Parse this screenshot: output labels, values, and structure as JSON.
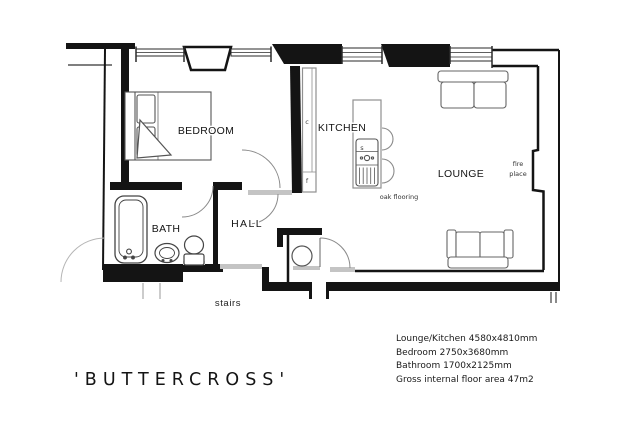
{
  "title": "'BUTTERCROSS'",
  "plan": {
    "rooms": [
      {
        "id": "bedroom",
        "label": "BEDROOM"
      },
      {
        "id": "kitchen",
        "label": "KITCHEN"
      },
      {
        "id": "lounge",
        "label": "LOUNGE"
      },
      {
        "id": "bath",
        "label": "BATH"
      },
      {
        "id": "hall",
        "label": "HALL"
      }
    ],
    "annotations": {
      "fireplace_line1": "fire",
      "fireplace_line2": "place",
      "oak_flooring": "oak flooring",
      "stairs": "stairs"
    },
    "fixture_labels": {
      "counter_c": "c",
      "counter_f": "f",
      "sink_s": "s"
    }
  },
  "notes": {
    "lines": [
      "Lounge/Kitchen 4580x4810mm",
      "Bedroom 2750x3680mm",
      "Bathroom 1700x2125mm",
      "Gross internal floor area 47m2"
    ]
  },
  "colors": {
    "ink": "#141414",
    "furniture_line": "#555555",
    "sill": "#c4c4c4",
    "background": "#ffffff"
  }
}
